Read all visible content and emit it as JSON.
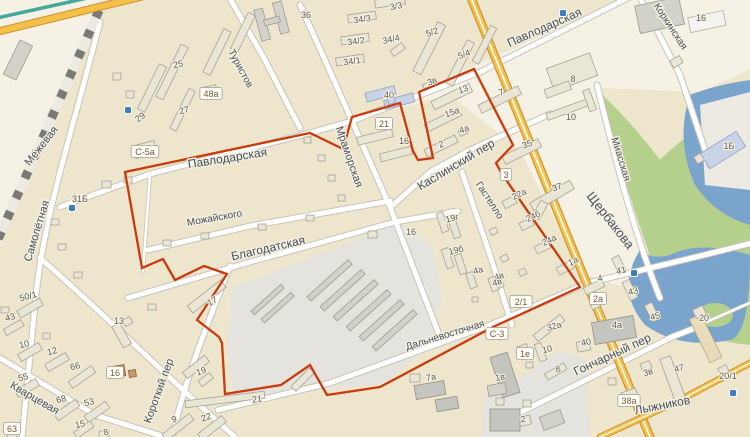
{
  "map": {
    "type": "city-map",
    "colors": {
      "land": "#ede5cc",
      "block_light": "#f5f1e4",
      "industrial": "#e4e3de",
      "park": "#b5cf8c",
      "water": "#7aa4cc",
      "road_fill": "#ffffff",
      "road_casing": "#c9c4b8",
      "major_road": "#f3c14a",
      "major_road_casing": "#d28f2b",
      "boundary": "#c93b0c",
      "building": "#eae6d6",
      "building_blue": "#c9d3e8",
      "building_brown": "#c79b72"
    },
    "boundary": {
      "color": "#c93b0c",
      "points": "125,172 310,133 343,149 352,117 400,103 413,151 418,160 433,158 419,92 474,69 513,145 496,163 502,174 580,287 493,327 380,387 327,395 310,365 281,385 225,394 222,343 219,337 197,320 227,274 204,266 175,280 163,259 142,268"
    },
    "street_labels": [
      {
        "text": "Межевая",
        "x": 44,
        "y": 148,
        "rot": -52,
        "size": 11
      },
      {
        "text": "Самолётная",
        "x": 40,
        "y": 232,
        "rot": -73,
        "size": 11
      },
      {
        "text": "Туристов",
        "x": 238,
        "y": 70,
        "rot": 62,
        "size": 10
      },
      {
        "text": "Павлодарская",
        "x": 228,
        "y": 162,
        "rot": -9,
        "size": 12
      },
      {
        "text": "Павлодарская",
        "x": 546,
        "y": 31,
        "rot": -24,
        "size": 12
      },
      {
        "text": "Коркинская",
        "x": 668,
        "y": 28,
        "rot": 57,
        "size": 10
      },
      {
        "text": "Миасская",
        "x": 618,
        "y": 160,
        "rot": 73,
        "size": 10
      },
      {
        "text": "Щербакова",
        "x": 607,
        "y": 223,
        "rot": 52,
        "size": 13
      },
      {
        "text": "Мраморская",
        "x": 346,
        "y": 158,
        "rot": 71,
        "size": 11
      },
      {
        "text": "Каслинский пер",
        "x": 458,
        "y": 168,
        "rot": -31,
        "size": 12
      },
      {
        "text": "Гастелло",
        "x": 487,
        "y": 202,
        "rot": 57,
        "size": 10
      },
      {
        "text": "Можайского",
        "x": 215,
        "y": 221,
        "rot": -10,
        "size": 10
      },
      {
        "text": "Благодатская",
        "x": 269,
        "y": 252,
        "rot": -13,
        "size": 12
      },
      {
        "text": "Дальневосточная",
        "x": 446,
        "y": 338,
        "rot": -17,
        "size": 10
      },
      {
        "text": "Короткий пер",
        "x": 162,
        "y": 392,
        "rot": -70,
        "size": 11
      },
      {
        "text": "Кварцевая",
        "x": 33,
        "y": 401,
        "rot": 30,
        "size": 11
      },
      {
        "text": "Гончарный пер",
        "x": 614,
        "y": 358,
        "rot": -25,
        "size": 12
      },
      {
        "text": "Лыжников",
        "x": 663,
        "y": 409,
        "rot": -11,
        "size": 12
      }
    ],
    "building_labels": [
      {
        "text": "25",
        "x": 178,
        "y": 64,
        "rot": -15
      },
      {
        "text": "48а",
        "x": 211,
        "y": 94,
        "boxed": true
      },
      {
        "text": "27",
        "x": 184,
        "y": 110,
        "rot": -15
      },
      {
        "text": "29",
        "x": 140,
        "y": 117,
        "rot": -35
      },
      {
        "text": "С-5а",
        "x": 145,
        "y": 152,
        "boxed": true
      },
      {
        "text": "31Б",
        "x": 80,
        "y": 199
      },
      {
        "text": "36",
        "x": 306,
        "y": 15
      },
      {
        "text": "3/3",
        "x": 396,
        "y": 6,
        "rot": -12
      },
      {
        "text": "34/3",
        "x": 362,
        "y": 19,
        "rot": -8
      },
      {
        "text": "34/2",
        "x": 356,
        "y": 41,
        "rot": -8
      },
      {
        "text": "34/4",
        "x": 391,
        "y": 39,
        "rot": -12
      },
      {
        "text": "34/1",
        "x": 352,
        "y": 61,
        "rot": -8
      },
      {
        "text": "5/2",
        "x": 432,
        "y": 32,
        "rot": -20
      },
      {
        "text": "5/4",
        "x": 464,
        "y": 54,
        "rot": -20
      },
      {
        "text": "40",
        "x": 389,
        "y": 95
      },
      {
        "text": "21",
        "x": 384,
        "y": 124,
        "boxed": true
      },
      {
        "text": "16",
        "x": 404,
        "y": 141
      },
      {
        "text": "3в",
        "x": 432,
        "y": 81,
        "rot": -20
      },
      {
        "text": "13",
        "x": 463,
        "y": 89,
        "rot": -20
      },
      {
        "text": "15а",
        "x": 452,
        "y": 112,
        "rot": -20
      },
      {
        "text": "4а",
        "x": 464,
        "y": 129,
        "rot": -20
      },
      {
        "text": "2",
        "x": 441,
        "y": 144,
        "rot": -20
      },
      {
        "text": "7",
        "x": 501,
        "y": 92,
        "rot": -20
      },
      {
        "text": "8",
        "x": 573,
        "y": 79
      },
      {
        "text": "10",
        "x": 571,
        "y": 117
      },
      {
        "text": "16",
        "x": 701,
        "y": 18
      },
      {
        "text": "1Б",
        "x": 729,
        "y": 146
      },
      {
        "text": "35",
        "x": 527,
        "y": 144,
        "rot": -20
      },
      {
        "text": "37",
        "x": 557,
        "y": 187,
        "rot": -20
      },
      {
        "text": "3",
        "x": 506,
        "y": 175,
        "boxed": true
      },
      {
        "text": "22а",
        "x": 519,
        "y": 194,
        "rot": -25
      },
      {
        "text": "24б",
        "x": 533,
        "y": 216,
        "rot": -25
      },
      {
        "text": "24а",
        "x": 549,
        "y": 240,
        "rot": -25
      },
      {
        "text": "1а",
        "x": 573,
        "y": 261,
        "rot": -25
      },
      {
        "text": "4в",
        "x": 499,
        "y": 276,
        "rot": -20
      },
      {
        "text": "4",
        "x": 600,
        "y": 278,
        "rot": -15
      },
      {
        "text": "41",
        "x": 621,
        "y": 270,
        "rot": -15
      },
      {
        "text": "43",
        "x": 633,
        "y": 291,
        "rot": -15
      },
      {
        "text": "2а",
        "x": 598,
        "y": 299,
        "boxed": true
      },
      {
        "text": "45",
        "x": 655,
        "y": 316,
        "rot": -15
      },
      {
        "text": "4а",
        "x": 617,
        "y": 325
      },
      {
        "text": "40",
        "x": 586,
        "y": 342,
        "rot": -12
      },
      {
        "text": "20",
        "x": 704,
        "y": 318
      },
      {
        "text": "20/1",
        "x": 728,
        "y": 376
      },
      {
        "text": "47",
        "x": 679,
        "y": 368,
        "rot": -15
      },
      {
        "text": "3в",
        "x": 648,
        "y": 372,
        "rot": -15
      },
      {
        "text": "38а",
        "x": 629,
        "y": 401,
        "boxed": true
      },
      {
        "text": "2",
        "x": 523,
        "y": 419,
        "rot": -12
      },
      {
        "text": "1е",
        "x": 525,
        "y": 354,
        "boxed": true
      },
      {
        "text": "10",
        "x": 547,
        "y": 349,
        "rot": -15
      },
      {
        "text": "8",
        "x": 558,
        "y": 369,
        "rot": -15
      },
      {
        "text": "32а",
        "x": 554,
        "y": 326,
        "rot": -15
      },
      {
        "text": "2/1",
        "x": 521,
        "y": 302,
        "boxed": true
      },
      {
        "text": "С-3",
        "x": 497,
        "y": 334,
        "boxed": true
      },
      {
        "text": "1в",
        "x": 500,
        "y": 377,
        "rot": -12
      },
      {
        "text": "7а",
        "x": 431,
        "y": 377,
        "rot": -12
      },
      {
        "text": "19г",
        "x": 452,
        "y": 218,
        "rot": -15
      },
      {
        "text": "19б",
        "x": 456,
        "y": 250,
        "rot": -15
      },
      {
        "text": "16",
        "x": 411,
        "y": 232
      },
      {
        "text": "4а",
        "x": 478,
        "y": 270,
        "rot": -15
      },
      {
        "text": "4в",
        "x": 497,
        "y": 282,
        "rot": -15
      },
      {
        "text": "50/1",
        "x": 28,
        "y": 296,
        "rot": -15
      },
      {
        "text": "43",
        "x": 10,
        "y": 317,
        "rot": -15
      },
      {
        "text": "10",
        "x": 24,
        "y": 344,
        "rot": -15
      },
      {
        "text": "12",
        "x": 52,
        "y": 351,
        "rot": -15
      },
      {
        "text": "66",
        "x": 75,
        "y": 366,
        "rot": -15
      },
      {
        "text": "55",
        "x": 23,
        "y": 377,
        "rot": -15
      },
      {
        "text": "68",
        "x": 61,
        "y": 399,
        "rot": -15
      },
      {
        "text": "53",
        "x": 89,
        "y": 402,
        "rot": -15
      },
      {
        "text": "13",
        "x": 119,
        "y": 321
      },
      {
        "text": "16",
        "x": 115,
        "y": 373,
        "boxed": true
      },
      {
        "text": "63",
        "x": 12,
        "y": 429,
        "boxed": true
      },
      {
        "text": "15",
        "x": 80,
        "y": 424,
        "rot": -15
      },
      {
        "text": "8",
        "x": 106,
        "y": 432,
        "rot": -15
      },
      {
        "text": "9",
        "x": 174,
        "y": 419,
        "rot": -20
      },
      {
        "text": "17",
        "x": 212,
        "y": 301,
        "rot": -30
      },
      {
        "text": "19",
        "x": 201,
        "y": 371,
        "rot": -20
      },
      {
        "text": "21",
        "x": 257,
        "y": 399,
        "rot": -8
      },
      {
        "text": "22",
        "x": 206,
        "y": 417,
        "rot": -20
      }
    ],
    "poi_icons": [
      {
        "name": "bus-stop-icon",
        "x": 128,
        "y": 110
      },
      {
        "name": "bus-stop-icon",
        "x": 72,
        "y": 208
      },
      {
        "name": "bus-stop-icon",
        "x": 563,
        "y": 13
      },
      {
        "name": "bus-stop-icon",
        "x": 634,
        "y": 273
      },
      {
        "name": "bus-stop-icon",
        "x": 733,
        "y": 393
      }
    ]
  }
}
